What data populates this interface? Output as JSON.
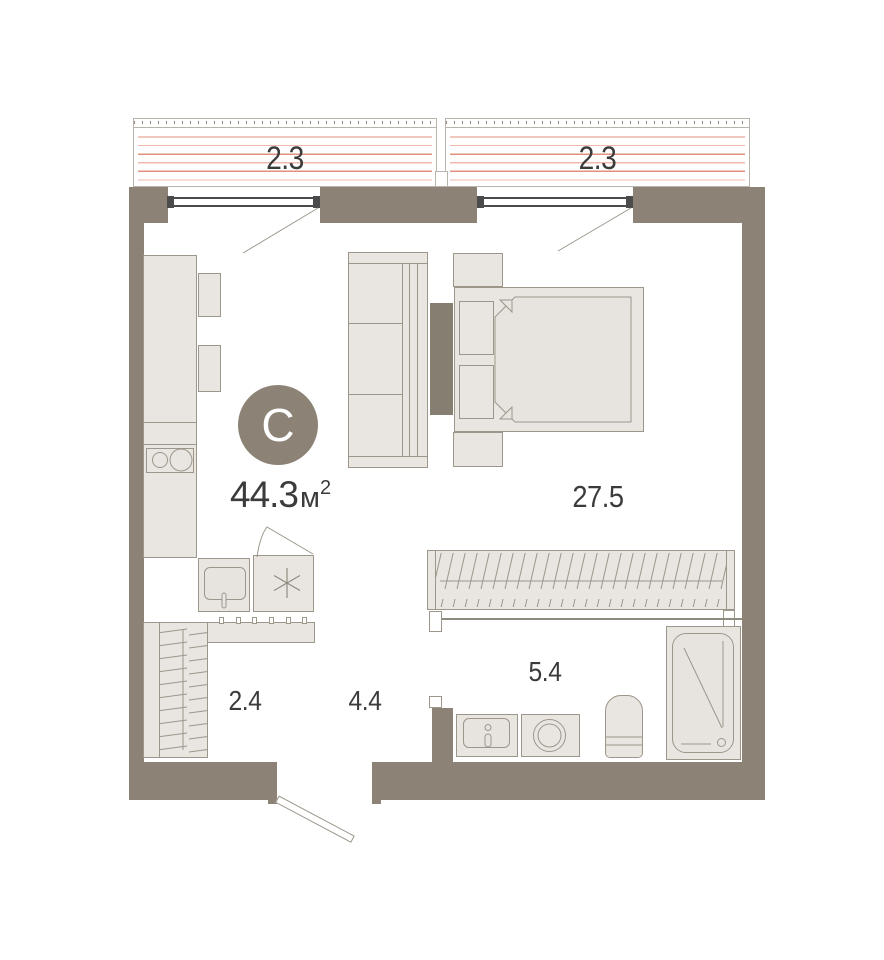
{
  "unit": {
    "type_letter": "С",
    "area_value": "44.3",
    "area_unit": "м",
    "area_sup": "2"
  },
  "rooms": [
    {
      "name": "living-room",
      "label": "27.5"
    },
    {
      "name": "bathroom",
      "label": "5.4"
    },
    {
      "name": "hallway",
      "label": "4.4"
    },
    {
      "name": "closet",
      "label": "2.4"
    }
  ],
  "balconies": [
    {
      "label": "2.3"
    },
    {
      "label": "2.3"
    }
  ],
  "colors": {
    "wall": "#8c8376",
    "wall_dark": "#867e70",
    "fill": "#e9e6e1",
    "fill_soft": "#e7e4df",
    "stroke": "#9c968b",
    "thin": "#908b81",
    "window": "#4b4b4b",
    "stripe": "#e2907e",
    "stripe_light": "#f0b9ab",
    "text": "#3b3b3b",
    "badge_bg": "#8c8376",
    "badge_text": "#ffffff",
    "border_light": "#bab5ac"
  }
}
